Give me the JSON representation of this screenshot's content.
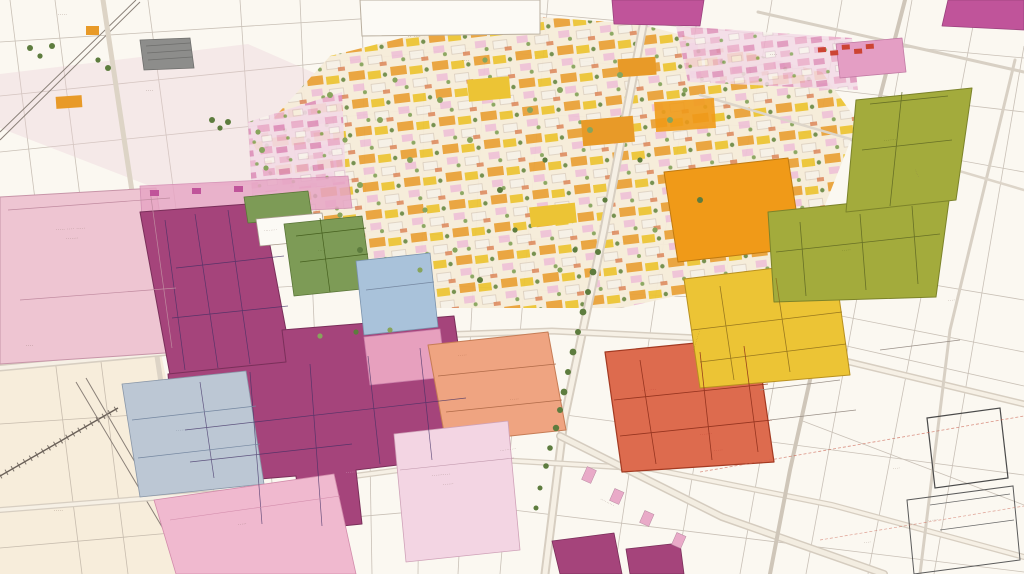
{
  "meta": {
    "view": "oblique aerial parcel map",
    "drawing_style": "hand-drawn plat with colored zoning parcels"
  },
  "palette": {
    "bgWhite": "#fbf8f1",
    "creamDeep": "#f5e7d0",
    "roadFill": "#d7cec1",
    "roadInner": "#f6f0e5",
    "roadLine": "#a2978a",
    "sketch": "#a89c90",
    "magenta": "#a5447b",
    "magentaDark": "#3f2d63",
    "magentaBright": "#c0549a",
    "pinkHospital": "#eec5d2",
    "pinkStrip": "#e7a6c5",
    "pinkMid": "#efaac6",
    "pinkBottom": "#f0b9cf",
    "lightPink": "#f3d5e3",
    "pinkBlock": "#e49ec4",
    "blueLight": "#a9c2da",
    "blueGray": "#bcc7d4",
    "greenField": "#7d9b56",
    "olive": "#a3ab3c",
    "gold": "#ecc435",
    "orange": "#e89a28",
    "deepOrange": "#f09a18",
    "salmon": "#efa481",
    "redOrange": "#dd6b4e",
    "treeGreen": "#5d7c3e",
    "treeLight": "#87a45c",
    "grayRoof": "#8d8d8b",
    "inkBrown": "#7a6258",
    "inkRed": "#b8352a",
    "whiteBuilding": "#fcfaf5",
    "tintPink": "#eccfd8"
  },
  "labels": {
    "hospital_line1": "····· ···· ·····",
    "hospital_line2": "·······",
    "cream_a": "····",
    "cream_b": "·····",
    "cream_rail": "··· ···· ···",
    "top_left_a": "·····",
    "top_left_b": "····",
    "top_center_a": "·· ····",
    "top_center_b": "····",
    "top_right_a": "····",
    "right_road": "·····",
    "right_mid": "····",
    "white_strip": "········",
    "green_field": "····",
    "blue_gray": "·······",
    "magenta_interior": "·····",
    "pink_bottom": "·····",
    "light_pink_line1": "··········",
    "light_pink_line2": "······",
    "salmon_a": "·····",
    "salmon_b": "·····",
    "street_a": "··········",
    "street_b": "·········",
    "red_a": "··· ····",
    "red_b": "·······",
    "red_c": "·····",
    "yellow_edge": "·············",
    "olive_a": "·······",
    "olive_b": "·····",
    "br_a": "····",
    "br_b": "······",
    "br_c": "····"
  }
}
